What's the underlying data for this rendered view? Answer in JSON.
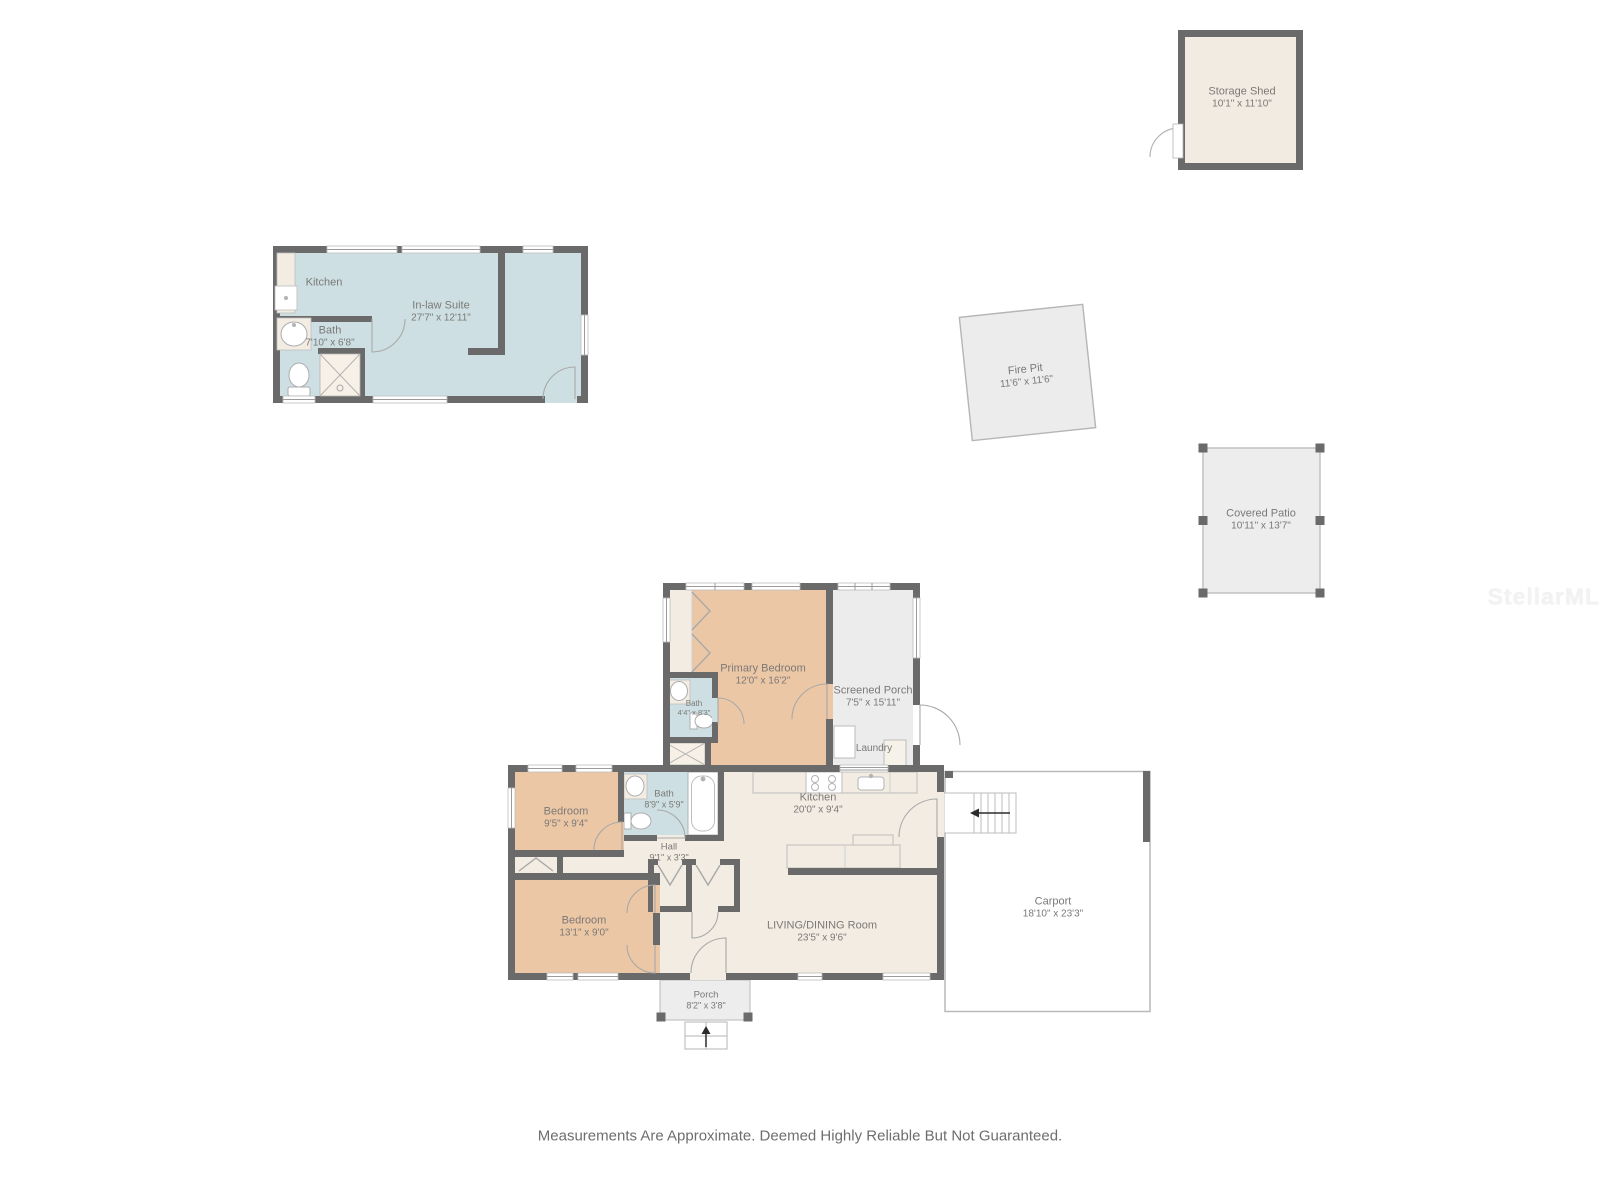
{
  "watermark": {
    "text": "StellarMLS"
  },
  "disclaimer": "Measurements Are Approximate. Deemed Highly Reliable But Not Guaranteed.",
  "colors": {
    "wall": "#6a6a6a",
    "bedroom_fill": "#ecc7a5",
    "wet_room_fill": "#cddfe2",
    "interior_fill": "#f2ece3",
    "outdoor_fill": "#ececec",
    "label_text": "#7b7977"
  },
  "rooms": {
    "storage_shed": {
      "name": "Storage Shed",
      "dims": "10'1\" x 11'10\""
    },
    "inlaw_kitchen": {
      "name": "Kitchen"
    },
    "inlaw_bath": {
      "name": "Bath",
      "dims": "7'10\" x 6'8\""
    },
    "inlaw_suite": {
      "name": "In-law Suite",
      "dims": "27'7\" x 12'11\""
    },
    "fire_pit": {
      "name": "Fire Pit",
      "dims": "11'6\" x 11'6\""
    },
    "covered_patio": {
      "name": "Covered Patio",
      "dims": "10'11\" x 13'7\""
    },
    "primary_bedroom": {
      "name": "Primary Bedroom",
      "dims": "12'0\" x 16'2\""
    },
    "screened_porch": {
      "name": "Screened Porch",
      "dims": "7'5\" x 15'11\""
    },
    "primary_bath": {
      "name": "Bath",
      "dims": "4'4\" x 8'3\""
    },
    "laundry": {
      "name": "Laundry"
    },
    "hall_bath": {
      "name": "Bath",
      "dims": "8'9\" x 5'9\""
    },
    "bedroom_small": {
      "name": "Bedroom",
      "dims": "9'5\" x 9'4\""
    },
    "hall": {
      "name": "Hall",
      "dims": "9'1\" x 3'3\""
    },
    "kitchen": {
      "name": "Kitchen",
      "dims": "20'0\" x 9'4\""
    },
    "bedroom_large": {
      "name": "Bedroom",
      "dims": "13'1\" x 9'0\""
    },
    "living_dining": {
      "name": "LIVING/DINING Room",
      "dims": "23'5\" x 9'6\""
    },
    "front_porch": {
      "name": "Porch",
      "dims": "8'2\" x 3'8\""
    },
    "carport": {
      "name": "Carport",
      "dims": "18'10\" x 23'3\""
    }
  }
}
